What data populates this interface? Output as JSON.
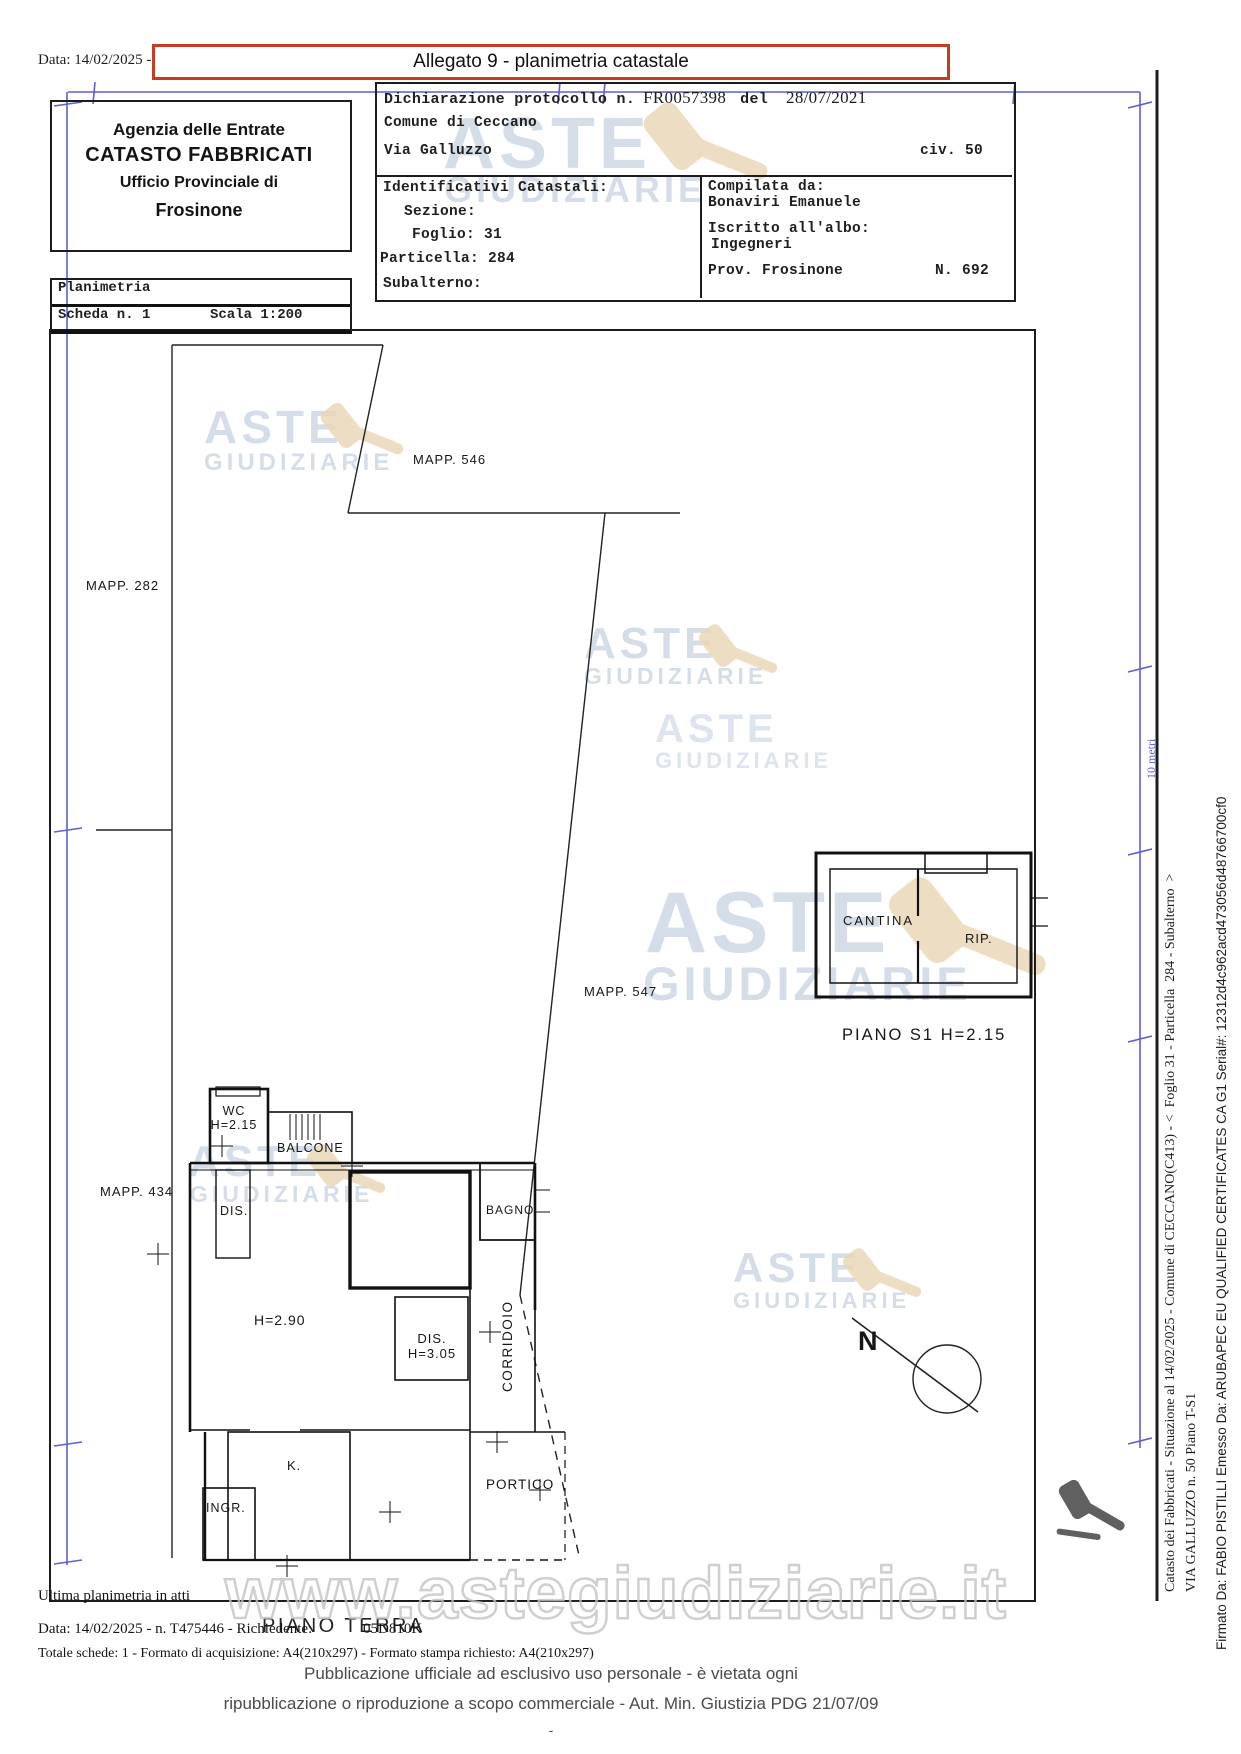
{
  "page": {
    "date_prefix": "Data: 14/02/2025 -",
    "allegato_title": "Allegato 9 - planimetria catastale"
  },
  "header": {
    "agency": {
      "line1": "Agenzia delle Entrate",
      "line2": "CATASTO FABBRICATI",
      "line3": "Ufficio Provinciale di",
      "line4": "Frosinone"
    },
    "planimetria_label": "Planimetria",
    "scheda": "Scheda n. 1",
    "scala": "Scala 1:200",
    "dichiarazione_label": "Dichiarazione protocollo n.",
    "protocollo": "FR0057398",
    "del_label": "del",
    "protocollo_data": "28/07/2021",
    "comune": "Comune di Ceccano",
    "via": "Via Galluzzo",
    "civico": "civ. 50",
    "identificativi": {
      "title": "Identificativi Catastali:",
      "sezione": "Sezione:",
      "foglio": "Foglio: 31",
      "particella": "Particella: 284",
      "subalterno": "Subalterno:"
    },
    "compilata": {
      "label": "Compilata da:",
      "nome": "Bonaviri Emanuele",
      "albo_label": "Iscritto all'albo:",
      "albo": "Ingegneri",
      "prov": "Prov. Frosinone",
      "numero": "N. 692"
    }
  },
  "plan": {
    "mapp": {
      "m546": "MAPP. 546",
      "m282": "MAPP. 282",
      "m434": "MAPP. 434",
      "m547": "MAPP. 547"
    },
    "rooms": {
      "cantina": "CANTINA",
      "rip": "RIP.",
      "wc": "WC",
      "wc_h": "H=2.15",
      "balcone": "BALCONE",
      "dis1": "DIS.",
      "bagno": "BAGNO",
      "h290": "H=2.90",
      "dis2": "DIS.",
      "dis2_h": "H=3.05",
      "corridoio": "CORRIDOIO",
      "k": "K.",
      "ingr": "INGR.",
      "portico": "PORTICO"
    },
    "floors": {
      "s1": "PIANO S1 H=2.15",
      "terra": "PIANO TERRA"
    },
    "scale_note": "10 metri",
    "north": "N"
  },
  "watermark": {
    "aste": "ASTE",
    "giudiziarie": "GIUDIZIARIE",
    "url": "www.astegiudiziarie.it"
  },
  "footer": {
    "ultima": "Ultima planimetria in atti",
    "data_line": "Data: 14/02/2025 - n. T475446 - Richiedente:",
    "richiedente_tail": "05D810K",
    "totale": "Totale schede: 1 - Formato di acquisizione: A4(210x297) - Formato stampa richiesto: A4(210x297)",
    "pub1": "Pubblicazione ufficiale ad esclusivo uso personale - è vietata ogni",
    "pub2": "ripubblicazione o riproduzione a scopo commerciale - Aut. Min. Giustizia PDG 21/07/09",
    "dash": "-"
  },
  "sidebar": {
    "line1": "Catasto dei Fabbricati - Situazione al 14/02/2025 - Comune di CECCANO(C413) - <  Foglio 31 - Particella  284 - Subalterno  >",
    "line2": "VIA GALLUZZO n. 50 Piano T-S1",
    "line3": "Firmato Da: FABIO PISTILLI Emesso Da: ARUBAPEC EU QUALIFIED CERTIFICATES CA G1 Serial#: 12312d4c962acd473056d48766700cf0"
  },
  "colors": {
    "accent_red": "#c63b22",
    "ruler_blue": "#5f5fd0",
    "watermark_blue": "#b3c3d6",
    "watermark_tan": "#e9d6b5",
    "ink": "#1c1c1c"
  }
}
